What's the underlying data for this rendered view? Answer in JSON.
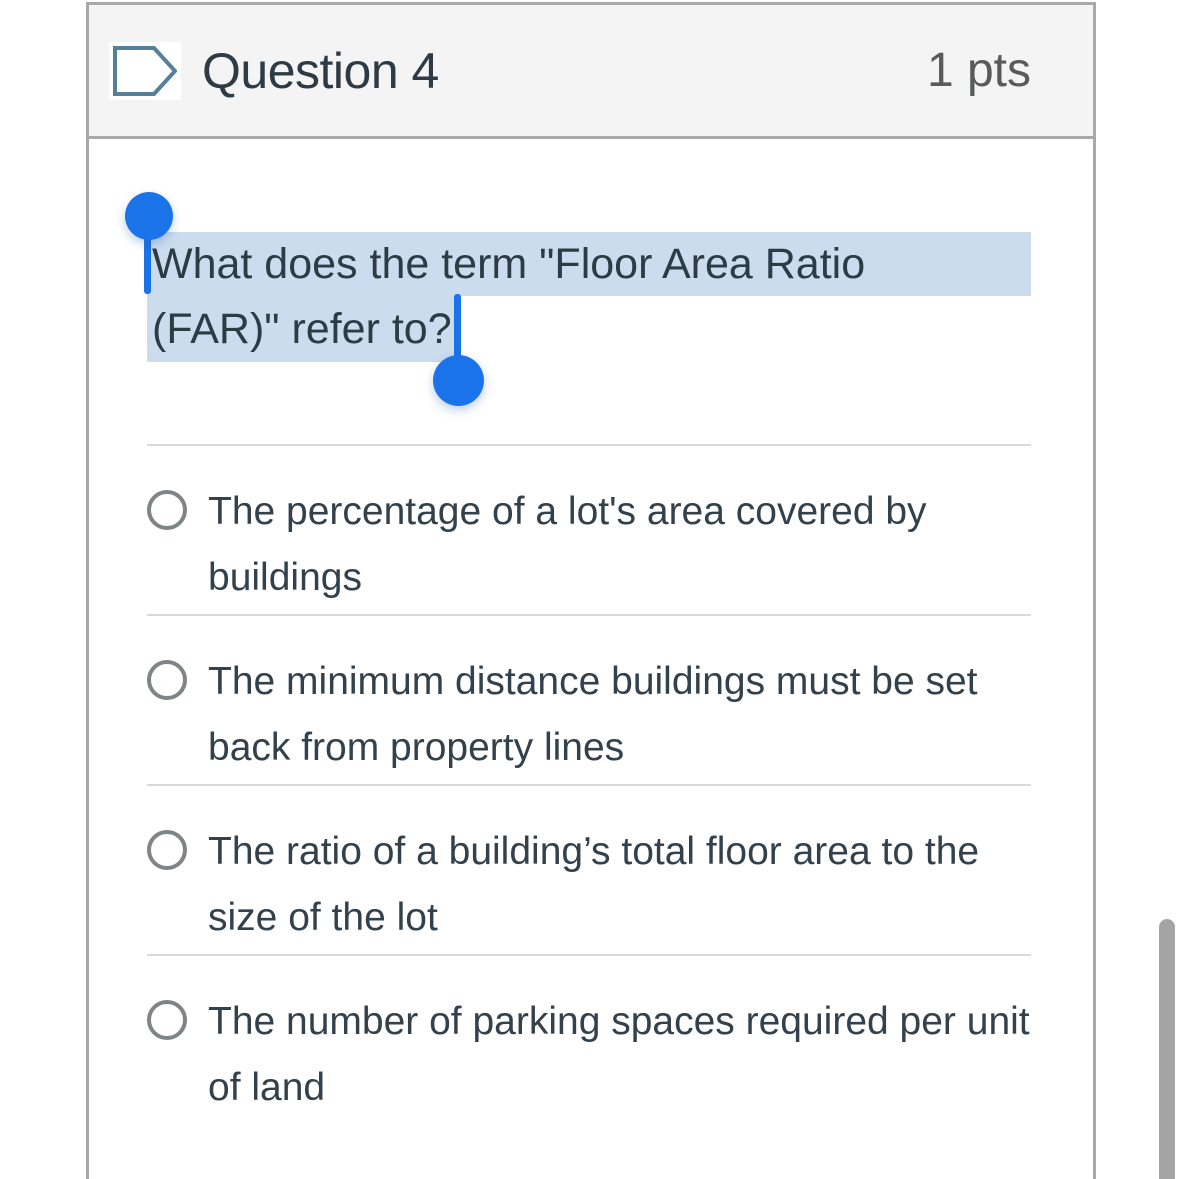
{
  "header": {
    "title": "Question 4",
    "points": "1 pts",
    "flag_icon": "question-flag-icon"
  },
  "question": {
    "text": "What does the term \"Floor Area Ratio (FAR)\" refer to?",
    "line1": "What does the term \"Floor Area Ratio",
    "line2": "(FAR)\" refer to?",
    "selection": {
      "active": true,
      "selected_text": "What does the term \"Floor Area Ratio (FAR)\" refer to?"
    }
  },
  "options": [
    {
      "label": "The percentage of a lot's area covered by buildings",
      "selected": false
    },
    {
      "label": "The minimum distance buildings must be set back from property lines",
      "selected": false
    },
    {
      "label": "The ratio of a building’s total floor area to the size of the lot",
      "selected": false
    },
    {
      "label": "The number of parking spaces required per unit of land",
      "selected": false
    }
  ],
  "colors": {
    "selection_highlight": "#cbdcee",
    "selection_handle": "#1a73e8",
    "text": "#2d3b45",
    "header_background": "#f4f4f4",
    "card_border": "#a9a9a9",
    "divider": "#d9d9d9",
    "flag_icon_stroke": "#54809c",
    "scrollbar": "#a4a4a4"
  },
  "scrollbar": {
    "visible": true,
    "orientation": "vertical"
  }
}
